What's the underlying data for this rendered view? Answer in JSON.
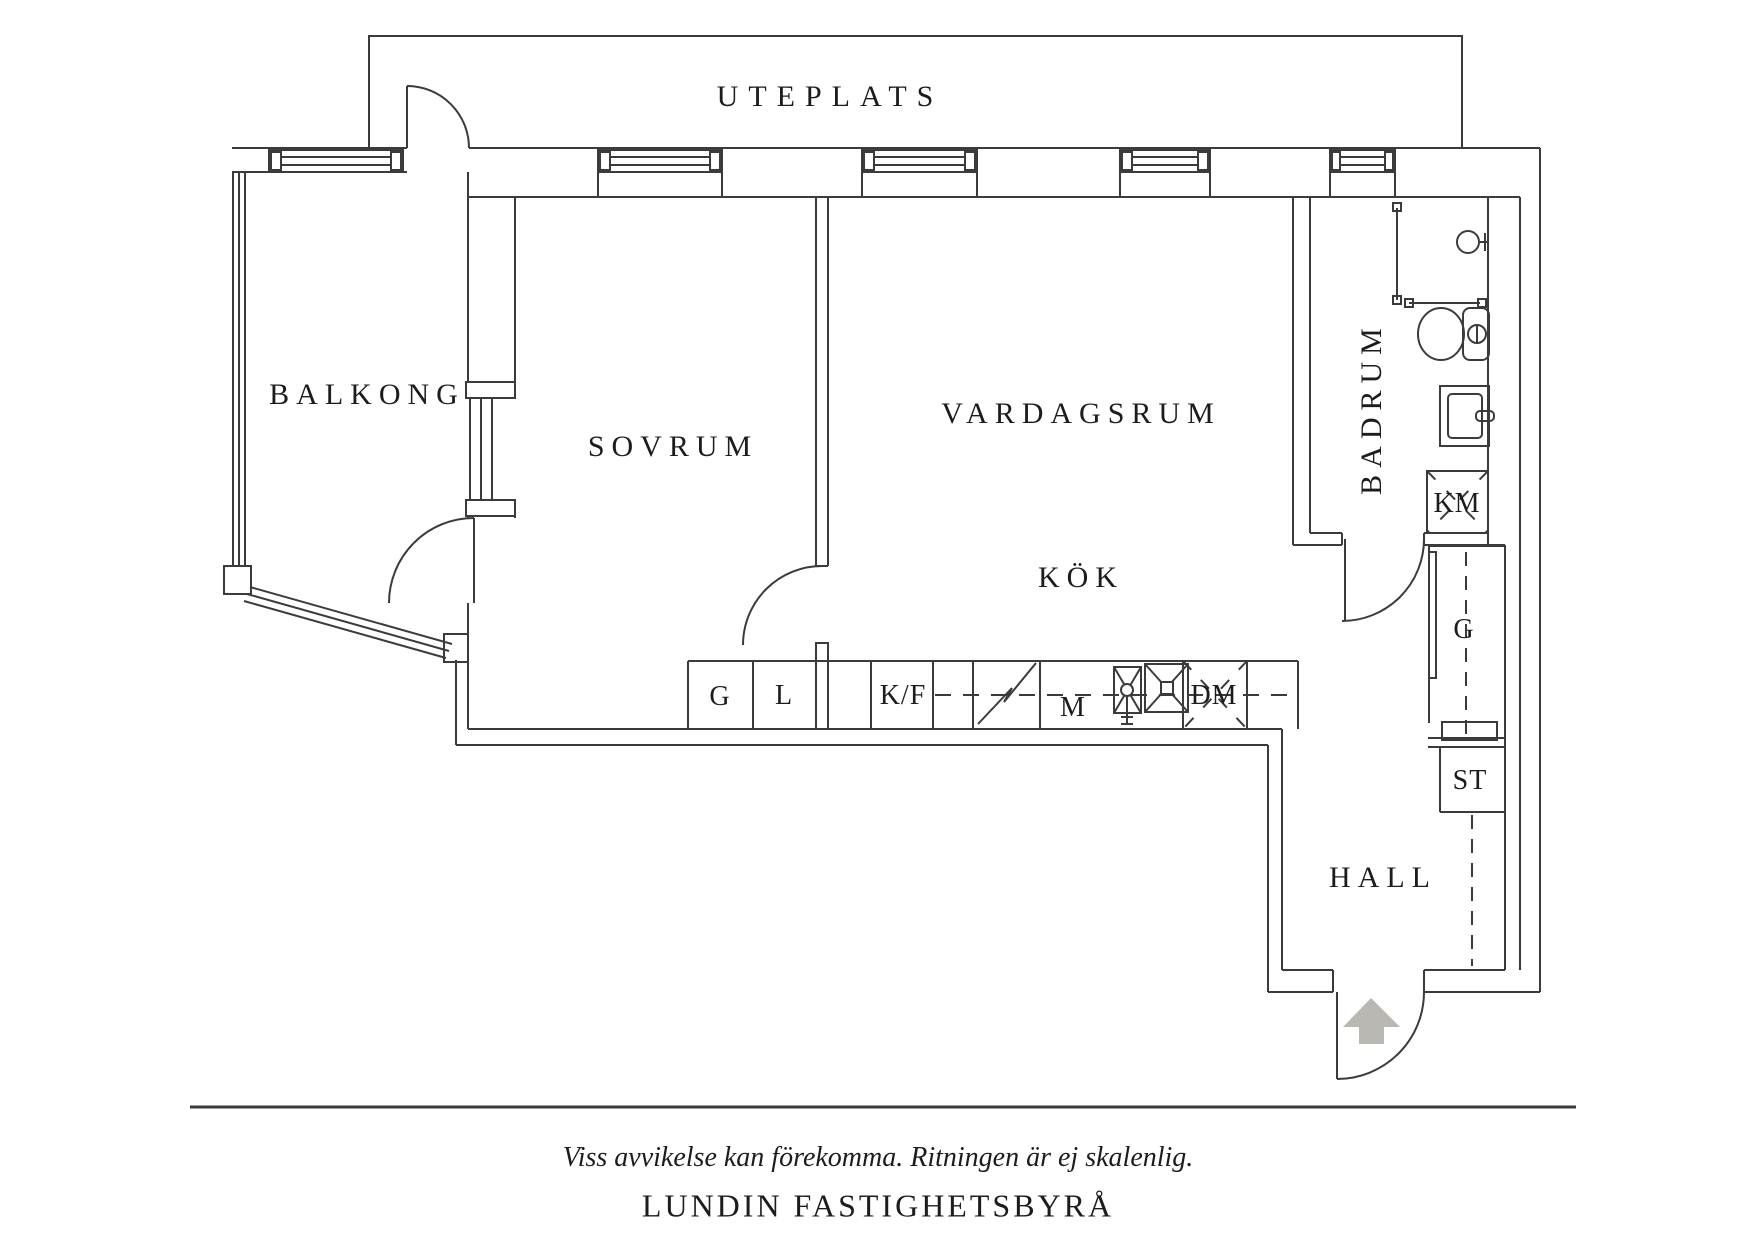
{
  "plan": {
    "rooms": {
      "uteplats": "UTEPLATS",
      "balkong": "BALKONG",
      "sovrum": "SOVRUM",
      "vardagsrum": "VARDAGSRUM",
      "kok": "KÖK",
      "badrum": "BADRUM",
      "hall": "HALL"
    },
    "fixtures": {
      "wardrobe_bedroom": "G",
      "linen_closet": "L",
      "fridge_freezer": "K/F",
      "micro": "M",
      "dishwasher": "DM",
      "washing_machine": "KM",
      "wardrobe_hall": "G",
      "cleaning_closet": "ST"
    },
    "icons": [
      "entrance-arrow-icon",
      "door-swing-icon",
      "window-icon",
      "shower-icon",
      "toilet-icon",
      "bathroom-sink-icon",
      "kitchen-sink-icon",
      "stove-icon"
    ]
  },
  "footer": {
    "disclaimer": "Viss avvikelse kan förekomma. Ritningen är ej skalenlig.",
    "brand": "LUNDIN FASTIGHETSBYRÅ"
  },
  "colors": {
    "line": "#3b3b3b",
    "arrow_fill": "#b9b8b3",
    "text": "#1c1c1c",
    "background": "#ffffff"
  }
}
